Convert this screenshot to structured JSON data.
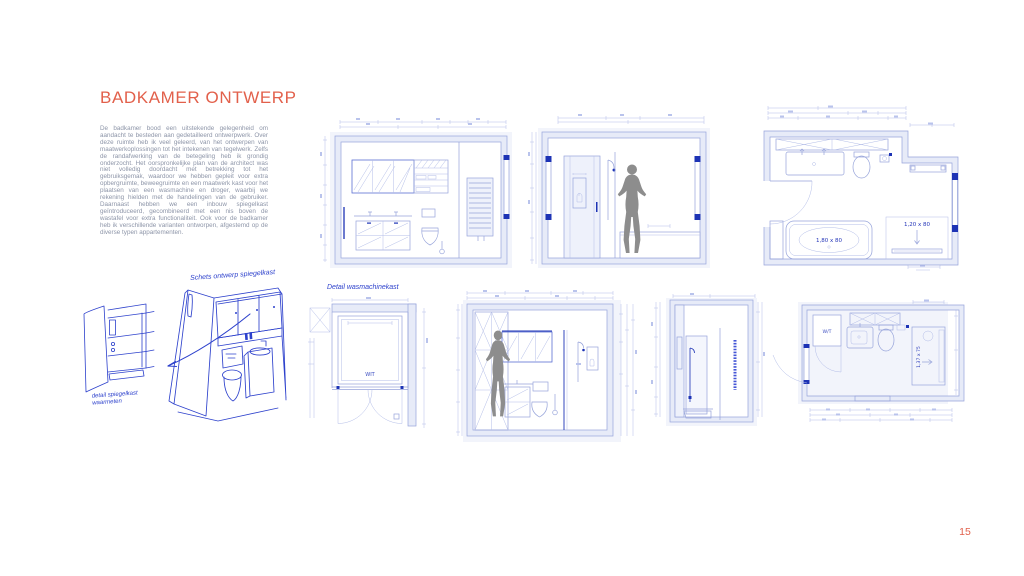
{
  "page": {
    "title": "BADKAMER ONTWERP",
    "number": "15"
  },
  "intro": {
    "text": "De badkamer bood een uitstekende gelegenheid om aandacht te besteden aan gedetailleerd ontwerpwerk. Over deze ruimte heb ik veel geleerd, van het ontwerpen van maatwerkoplossingen tot het intekenen van tegelwerk. Zelfs de randafwerking van de betegeling heb ik grondig onderzocht. Het oorspronkelijke plan van de architect was niet volledig doordacht met betrekking tot het gebruiksgemak, waardoor we hebben gepleit voor extra opbergruimte, beweegruimte en een maatwerk kast voor het plaatsen van een wasmachine en droger, waarbij we rekening hielden met de handelingen van de gebruiker. Daarnaast hebben we een inbouw spiegelkast geïntroduceerd, gecombineerd met een nis boven de wastafel voor extra functionaliteit. Ook voor de badkamer heb ik verschillende varianten ontworpen, afgestemd op de diverse typen appartementen."
  },
  "sketch_captions": {
    "mirror_design": "Schets ontwerp spiegelkast",
    "mirror_detail_line1": "detail spiegelkast",
    "mirror_detail_line2": "waarmeten",
    "washer_detail": "Detail wasmachinekast"
  },
  "drawing_labels": {
    "bath_size": "1,80 x 80",
    "shower_size": "1,20 x 80",
    "cabinet_finish": "WIT",
    "washer_dryer": "W/T",
    "shower2_size": "1,37 x 75"
  },
  "colors": {
    "accent_red": "#e2604b",
    "cad_line": "#96a3da",
    "cad_accent": "#1d33b5",
    "ink_blue": "#2d41cc",
    "silhouette": "#8d8d8d"
  }
}
